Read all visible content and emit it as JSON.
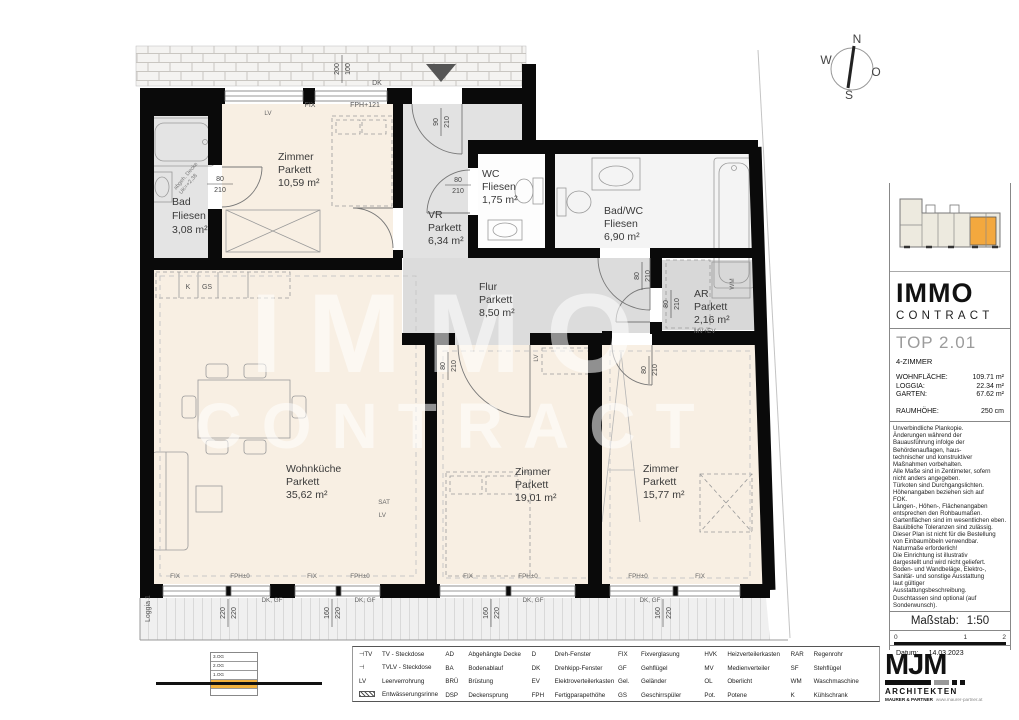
{
  "compass": {
    "n": "N",
    "w": "W",
    "o": "O",
    "s": "S"
  },
  "watermark": {
    "line1": "IMMO",
    "line2": "CONTRACT"
  },
  "plan": {
    "rooms": [
      {
        "name": "Zimmer",
        "surface": "Parkett",
        "area": "10,59 m²"
      },
      {
        "name": "Bad",
        "surface": "Fliesen",
        "area": "3,08 m²"
      },
      {
        "name": "VR",
        "surface": "Parkett",
        "area": "6,34 m²"
      },
      {
        "name": "WC",
        "surface": "Fliesen",
        "area": "1,75 m²"
      },
      {
        "name": "Bad/WC",
        "surface": "Fliesen",
        "area": "6,90 m²"
      },
      {
        "name": "Flur",
        "surface": "Parkett",
        "area": "8,50 m²"
      },
      {
        "name": "AR",
        "surface": "Parkett",
        "area": "2,16 m²",
        "note": "MV+EV"
      },
      {
        "name": "Wohnküche",
        "surface": "Parkett",
        "area": "35,62 m²"
      },
      {
        "name": "Zimmer",
        "surface": "Parkett",
        "area": "19,01 m²"
      },
      {
        "name": "Zimmer",
        "surface": "Parkett",
        "area": "15,77 m²"
      }
    ],
    "labels": {
      "fix": "FIX",
      "fph121": "FPH+121",
      "fph0": "FPH±0",
      "dk": "DK",
      "dk_gf": "DK, GF",
      "d80": "80",
      "d90": "90",
      "d200": "200",
      "d100": "100",
      "d210": "210",
      "d220": "220",
      "d160": "160",
      "k": "K",
      "gs": "GS",
      "lv": "LV",
      "sat": "SAT",
      "wm": "WM",
      "mv_ev": "MV+EV",
      "loggia": "Loggia 1",
      "abgeh1": "abgeh. Decke",
      "abgeh2": "UK=+2,38"
    }
  },
  "sidebar": {
    "brand": {
      "line1": "IMMO",
      "line2": "CONTRACT"
    },
    "unit": {
      "title": "TOP 2.01",
      "type": "4-ZIMMER",
      "stats": [
        {
          "label": "WOHNFLÄCHE:",
          "value": "109.71 m²"
        },
        {
          "label": "LOGGIA:",
          "value": "22.34 m²"
        },
        {
          "label": "GARTEN:",
          "value": "67.62 m²"
        }
      ],
      "height_label": "RAUMHÖHE:",
      "height_value": "250 cm"
    },
    "disclaimer": "Unverbindliche Plankopie.\nÄnderungen während der\nBauausführung infolge der\nBehördenauflagen, haus-\ntechnischer und konstruktiver\nMaßnahmen vorbehalten.\nAlle Maße sind in Zentimeter, sofern\nnicht anders angegeben.\nTürkoten sind Durchgangslichten.\nHöhenangaben beziehen sich auf\nFOK.\nLängen-, Höhen-, Flächenangaben\nentsprechen den Rohbaumaßen.\nGartenflächen sind im wesentlichen eben.\nBauübliche Toleranzen sind zulässig.\nDieser Plan ist nicht für die Bestellung\nvon Einbaumöbeln verwendbar.\nNaturmaße erforderlich!\nDie Einrichtung ist illustrativ\ndargestellt und wird nicht geliefert.\nBoden- und Wandbeläge, Elektro-,\nSanitär- und sonstige Ausstattung\nlaut gültiger\nAusstattungsbeschreibung.\nDuschtassen sind optional (auf\nSonderwunsch).",
    "scale": {
      "label": "Maßstab:",
      "value": "1:50",
      "ticks": [
        "0",
        "1",
        "2"
      ]
    },
    "date": {
      "label": "Datum:",
      "value": "14.03.2023"
    },
    "architect": {
      "logo": "MJM",
      "line1": "ARCHITEKTEN",
      "line2": "MAURER & PARTNER",
      "url": "www.maurer-partner.at"
    }
  },
  "legend": {
    "groups": [
      [
        {
          "abbr": "⊣TV",
          "label": "TV - Steckdose"
        },
        {
          "abbr": "⊣",
          "label": "TVLV - Steckdose"
        },
        {
          "abbr": "LV",
          "label": "Leerverrohrung"
        },
        {
          "abbr": "",
          "label": "Entwässerungsrinne"
        }
      ],
      [
        {
          "abbr": "AD",
          "label": "Abgehängte Decke"
        },
        {
          "abbr": "BA",
          "label": "Bodenablauf"
        },
        {
          "abbr": "BRÜ",
          "label": "Brüstung"
        },
        {
          "abbr": "DSP",
          "label": "Deckensprung"
        }
      ],
      [
        {
          "abbr": "D",
          "label": "Dreh-Fenster"
        },
        {
          "abbr": "DK",
          "label": "Drehkipp-Fenster"
        },
        {
          "abbr": "EV",
          "label": "Elektroverteilerkasten"
        },
        {
          "abbr": "FPH",
          "label": "Fertigparapethöhe"
        }
      ],
      [
        {
          "abbr": "FIX",
          "label": "Fixverglasung"
        },
        {
          "abbr": "GF",
          "label": "Gehflügel"
        },
        {
          "abbr": "Gel.",
          "label": "Geländer"
        },
        {
          "abbr": "GS",
          "label": "Geschirrspüler"
        }
      ],
      [
        {
          "abbr": "HVK",
          "label": "Heizverteilerkasten"
        },
        {
          "abbr": "MV",
          "label": "Medienverteiler"
        },
        {
          "abbr": "OL",
          "label": "Oberlicht"
        },
        {
          "abbr": "Pot.",
          "label": "Potene"
        }
      ],
      [
        {
          "abbr": "RAR",
          "label": "Regenrohr"
        },
        {
          "abbr": "SF",
          "label": "Stehflügel"
        },
        {
          "abbr": "WM",
          "label": "Waschmaschine"
        },
        {
          "abbr": "K",
          "label": "Kühlschrank"
        }
      ]
    ]
  },
  "floors": {
    "rows": [
      "3.OG",
      "2.OG",
      "1.OG",
      "EG",
      ""
    ]
  }
}
